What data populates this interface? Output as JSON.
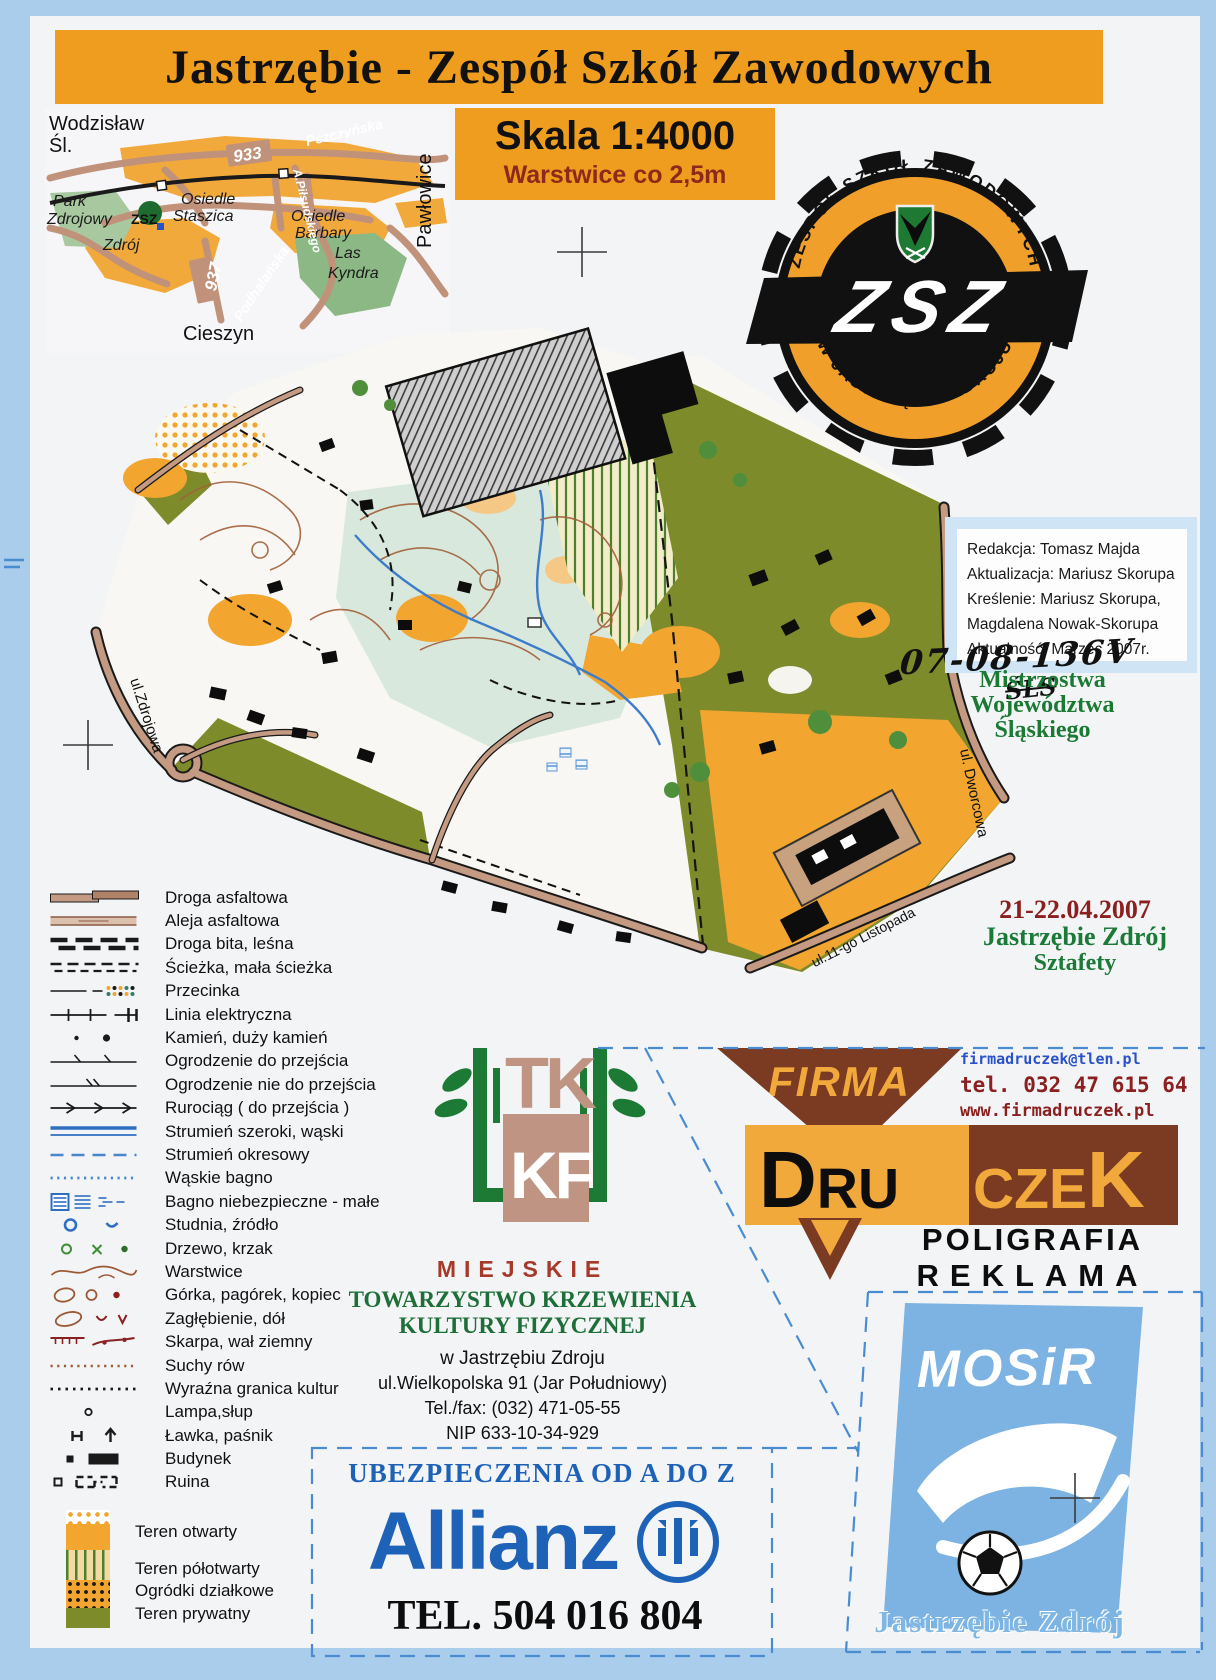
{
  "title": "Jastrzębie - Zespół Szkół Zawodowych",
  "scale": {
    "skala": "Skala 1:4000",
    "warstwice": "Warstwice co 2,5m"
  },
  "locator": {
    "wodzislaw_1": "Wodzisław",
    "wodzislaw_2": "Śl.",
    "cieszyn": "Cieszyn",
    "pawlowice": "Pawłowice",
    "park_1": "Park",
    "park_2": "Zdrojowy",
    "staszica_1": "Osiedle",
    "staszica_2": "Staszica",
    "barbary_1": "Osiedle",
    "barbary_2": "Barbary",
    "zdroj": "Zdrój",
    "las_1": "Las",
    "las_2": "Kyndra",
    "zsz": "ZSZ",
    "r933": "933",
    "r937": "937",
    "pszczynska": "Pszczyńska",
    "podhalanska": "Podhalańska",
    "pilsudskiego": "A.Piłsudskiego"
  },
  "zsz_logo": {
    "arc_top": "ZESPÓŁ SZKÓŁ ZAWODOWYCH",
    "arc_bottom": "W JASTRZĘBIU ZDROJU",
    "monogram": "ZSZ"
  },
  "credits": {
    "lines": [
      "Redakcja: Tomasz Majda",
      "Aktualizacja: Mariusz Skorupa",
      "Kreślenie: Mariusz Skorupa,",
      "Magdalena Nowak-Skorupa",
      "Aktualność: Marzec 2007r."
    ]
  },
  "handwritten": {
    "code": "07-08-136V",
    "sub": "ŚLS"
  },
  "championship": {
    "line1": "Mistrzostwa",
    "line2": "Województwa",
    "line3": "Śląskiego"
  },
  "event": {
    "date": "21-22.04.2007",
    "place": "Jastrzębie Zdrój",
    "kind": "Sztafety"
  },
  "map": {
    "labels": {
      "zdrojowa": "ul.Zdrojowa",
      "dworcowa": "ul. Dworcowa",
      "listopada": "ul.11-go Listopada"
    }
  },
  "legend": {
    "items": [
      {
        "id": "droga-asfaltowa",
        "label": "Droga asfaltowa"
      },
      {
        "id": "aleja-asfaltowa",
        "label": "Aleja asfaltowa"
      },
      {
        "id": "droga-bita",
        "label": "Droga bita, leśna"
      },
      {
        "id": "sciezka",
        "label": "Ścieżka, mała ścieżka"
      },
      {
        "id": "przecinka",
        "label": "Przecinka"
      },
      {
        "id": "linia-elektryczna",
        "label": "Linia elektryczna"
      },
      {
        "id": "kamien",
        "label": "Kamień, duży kamień"
      },
      {
        "id": "ogrodzenie-do",
        "label": "Ogrodzenie do przejścia"
      },
      {
        "id": "ogrodzenie-nie",
        "label": "Ogrodzenie nie do przejścia"
      },
      {
        "id": "rurociag",
        "label": "Rurociąg ( do przejścia )"
      },
      {
        "id": "strumien",
        "label": "Strumień szeroki, wąski"
      },
      {
        "id": "strumien-okresowy",
        "label": "Strumień okresowy"
      },
      {
        "id": "waskie-bagno",
        "label": "Wąskie bagno"
      },
      {
        "id": "bagno-niebezpieczne",
        "label": "Bagno niebezpieczne - małe"
      },
      {
        "id": "studnia",
        "label": "Studnia, źródło"
      },
      {
        "id": "drzewo",
        "label": "Drzewo, krzak"
      },
      {
        "id": "warstwice",
        "label": "Warstwice"
      },
      {
        "id": "gorka",
        "label": "Górka, pagórek, kopiec"
      },
      {
        "id": "zaglebienie",
        "label": "Zagłębienie, dół"
      },
      {
        "id": "skarpa",
        "label": "Skarpa, wał ziemny"
      },
      {
        "id": "suchy-row",
        "label": "Suchy  rów"
      },
      {
        "id": "granica-kultur",
        "label": "Wyraźna granica kultur"
      },
      {
        "id": "lampa",
        "label": "Lampa,słup"
      },
      {
        "id": "lawka",
        "label": "Ławka, paśnik"
      },
      {
        "id": "budynek",
        "label": "Budynek"
      },
      {
        "id": "ruina",
        "label": "Ruina"
      }
    ],
    "areas": [
      {
        "id": "teren-otwarty",
        "label": "Teren otwarty"
      },
      {
        "id": "teren-polotwarty",
        "label": "Teren półotwarty"
      },
      {
        "id": "ogrodki-dzialkowe",
        "label": "Ogródki działkowe"
      },
      {
        "id": "teren-prywatny",
        "label": "Teren prywatny"
      }
    ]
  },
  "tkkf": {
    "logo_top": "TK",
    "logo_bottom": "KF",
    "miejskie": "MIEJSKIE",
    "name2": "TOWARZYSTWO KRZEWIENIA",
    "name3": "KULTURY FIZYCZNEJ",
    "city": "w Jastrzębiu Zdroju",
    "street": "ul.Wielkopolska 91 (Jar Południowy)",
    "tel": "Tel./fax: (032) 471-05-55",
    "nip": "NIP 633-10-34-929"
  },
  "druczek": {
    "firma": "FIRMA",
    "email": "firmadruczek@tlen.pl",
    "tel": "tel. 032 47 615 64",
    "www": "www.firmadruczek.pl",
    "d": "D",
    "ru": "RU",
    "cze": "CZE",
    "k": "K",
    "line1": "POLIGRAFIA",
    "line2": "REKLAMA"
  },
  "mosir": {
    "name": "MOSiR",
    "city": "Jastrzębie Zdrój"
  },
  "allianz": {
    "tagline": "UBEZPIECZENIA OD A DO Z",
    "brand": "Allianz",
    "tel": "TEL. 504 016 804"
  },
  "colors": {
    "banner_orange": "#ef9d1f",
    "map_orange": "#f2a52f",
    "olive": "#7e8b2b",
    "road_tan": "#c49a82",
    "druczek_brown": "#7b3a22",
    "druczek_orange": "#f2a93c",
    "allianz_blue": "#1e62b8",
    "mosir_blue": "#7cb3e2",
    "green_text": "#1b7a38",
    "maroon_text": "#8b2020",
    "dash_blue": "#4a8cd2"
  }
}
